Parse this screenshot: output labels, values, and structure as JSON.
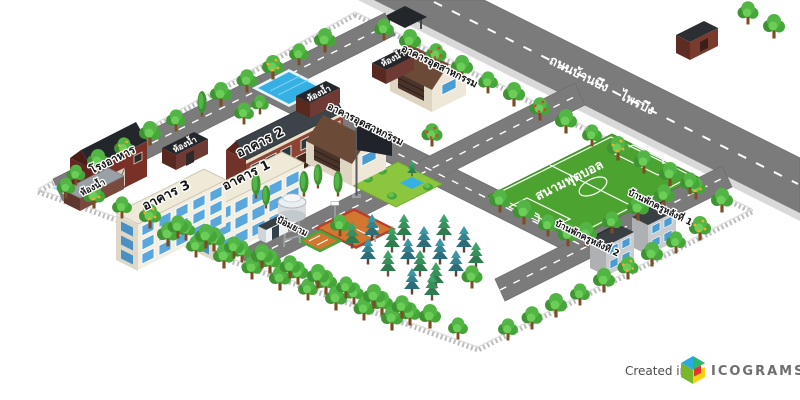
{
  "map": {
    "road_label": "ถนนบ้านบึง - ไพรบึง",
    "buildings": {
      "building_1": "อาคาร 1",
      "building_2": "อาคาร 2",
      "building_3": "อาคาร 3",
      "industrial_building": "อาคารอุตสาหกรรม",
      "cafeteria": "โรงอาหาร",
      "restroom": "ห้องน้ำ",
      "guard_post": "ป้อมยาม",
      "teacher_house_1": "บ้านพักครูหลังที่ 1",
      "teacher_house_2": "บ้านพักครูหลังที่ 2"
    },
    "areas": {
      "football_field": "สนามฟุตบอล"
    }
  },
  "watermark": {
    "created_in": "Created in",
    "brand": "ICOGRAMS"
  },
  "colors": {
    "road": "#7b7b7b",
    "road_line": "#ffffff",
    "field_green": "#4da32f",
    "lawn_green": "#8cc63f",
    "water_blue": "#35b0e5",
    "tree_green": "#47a63a",
    "pine_teal": "#338290",
    "fence_gray": "#bcbcbc",
    "brick_red": "#8d4437",
    "barn_red": "#7a2f27",
    "roof_dark": "#3d4449",
    "roof_brown": "#6b4a38",
    "wall_cream": "#f2eee2",
    "window_blue": "#5aa7dd",
    "house_gray": "#c9ccce",
    "court_orange": "#d2772f",
    "court_border_red": "#b5402f",
    "logo_blue": "#29abe2",
    "logo_green": "#76b82a",
    "logo_yellow": "#f5d40f",
    "logo_red": "#e8332a"
  }
}
